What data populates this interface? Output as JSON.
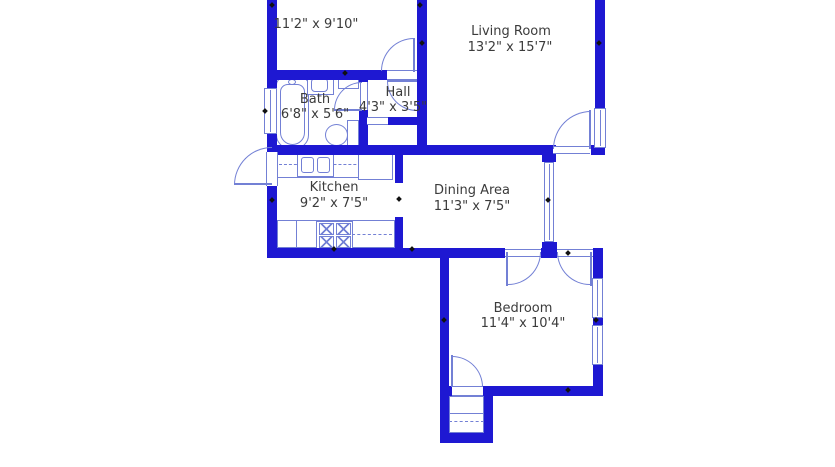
{
  "rooms": {
    "upper": {
      "dims": "11'2\" x 9'10\""
    },
    "living": {
      "name": "Living Room",
      "dims": "13'2\" x 15'7\""
    },
    "bath": {
      "name": "Bath",
      "dims": "6'8\" x 5'6\""
    },
    "hall": {
      "name": "Hall",
      "dims": "4'3\" x 3'5\""
    },
    "kitchen": {
      "name": "Kitchen",
      "dims": "9'2\" x 7'5\""
    },
    "dining": {
      "name": "Dining Area",
      "dims": "11'3\" x 7'5\""
    },
    "bedroom": {
      "name": "Bedroom",
      "dims": "11'4\" x 10'4\""
    }
  },
  "colors": {
    "wall": "#1e18d2",
    "fixture": "#7380d5",
    "text": "#3b3b3b",
    "background": "#ffffff"
  }
}
